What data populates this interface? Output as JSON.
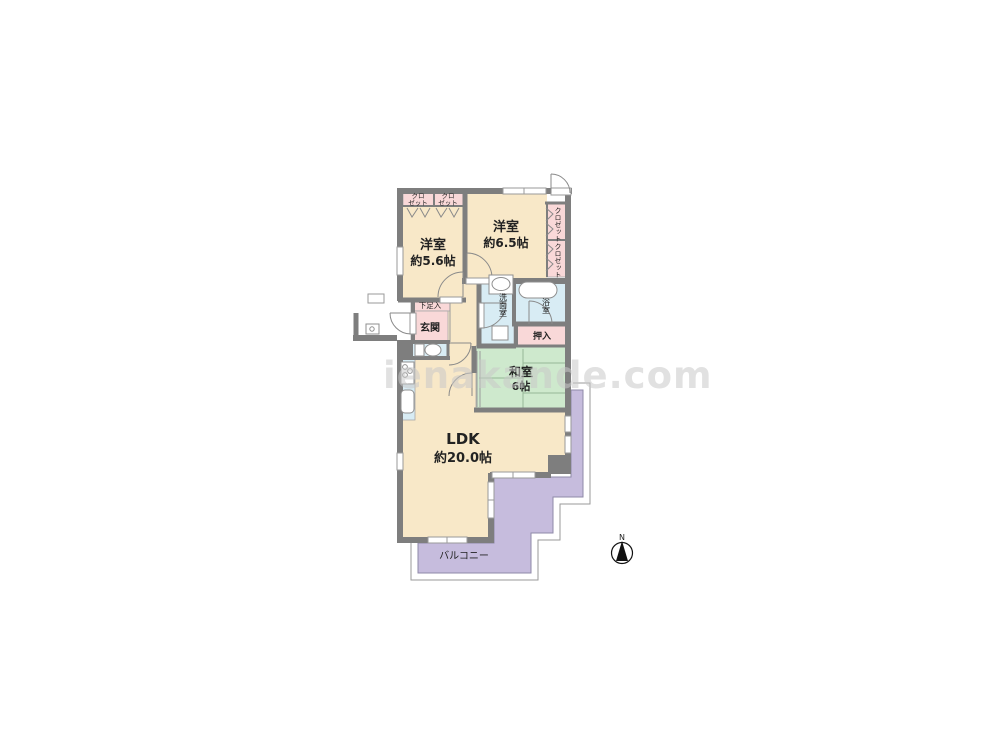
{
  "watermark": "ienakande.com",
  "compass": {
    "label": "N"
  },
  "palette": {
    "room_cream": "#F8E8C8",
    "closet_pink": "#F9D8D8",
    "wet_blue": "#D8ECF4",
    "tatami_green": "#CEE9CD",
    "balcony_purple": "#C6BCDD",
    "wall_gray": "#7E7E7E",
    "text_color": "#222222",
    "watermark_color": "#C9C9C9"
  },
  "rooms": {
    "western1": {
      "name": "洋室",
      "size": "約5.6帖"
    },
    "western2": {
      "name": "洋室",
      "size": "約6.5帖"
    },
    "ldk": {
      "name": "LDK",
      "size": "約20.0帖"
    },
    "japanese": {
      "name": "和室",
      "size": "6帖"
    },
    "genkan": {
      "label": "玄関"
    },
    "shoe": {
      "label": "下足入"
    },
    "washroom": {
      "label": "洗面室"
    },
    "bath": {
      "label": "浴室"
    },
    "oshiire": {
      "label": "押入"
    },
    "closet_a1": {
      "line1": "クロ",
      "line2": "ゼット"
    },
    "closet_a2": {
      "line1": "クロ",
      "line2": "ゼット"
    },
    "closet_b1": {
      "label": "クロゼット"
    },
    "closet_b2": {
      "label": "クロゼット"
    },
    "balcony": {
      "label": "バルコニー"
    }
  }
}
